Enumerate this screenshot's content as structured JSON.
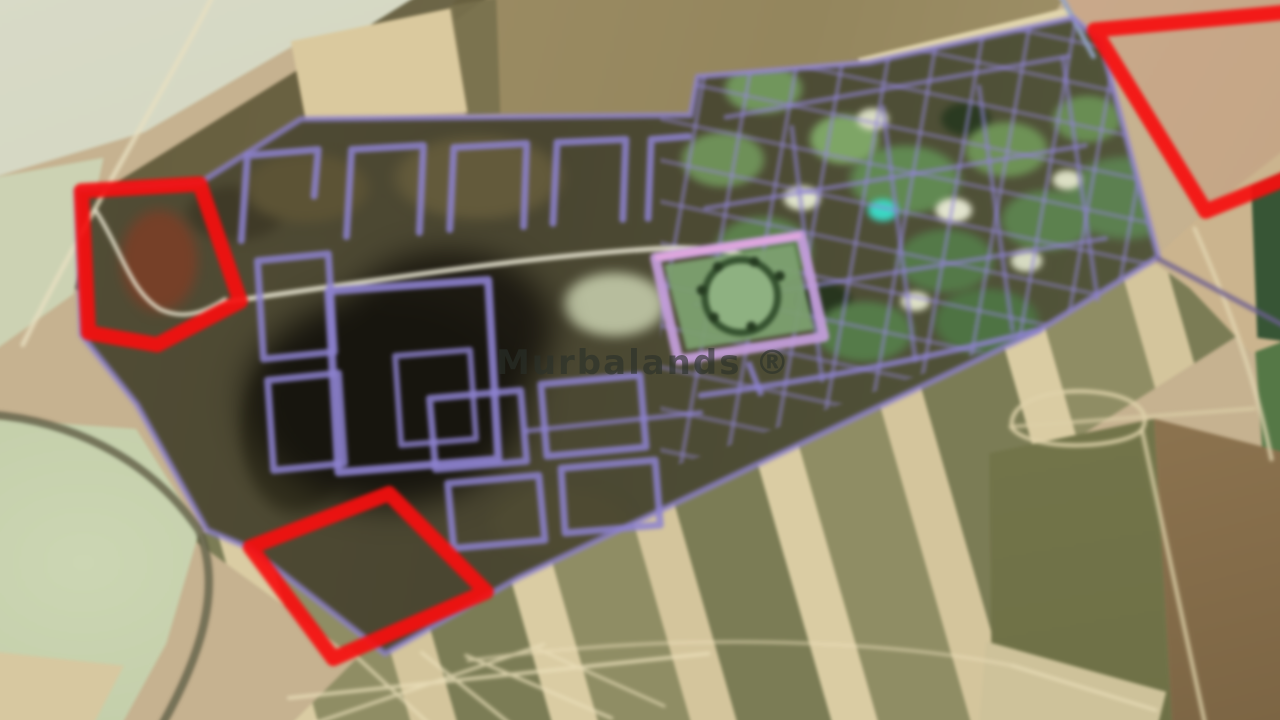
{
  "scene": {
    "kind": "aerial-satellite-photograph",
    "subject": "master-planned land development with purple street overlay, surrounded by farmland",
    "watermark": {
      "text": "Murbalands ®"
    },
    "colors": {
      "highlight_red": "#ee1111",
      "street_overlay_purple": "#8d82cc",
      "farmland_tan": "#c6b290",
      "development_dark_olive": "#4a4632"
    },
    "highlighted_plots": [
      {
        "name": "west-plot",
        "shape": "pentagon outline"
      },
      {
        "name": "southwest-plot",
        "shape": "diamond outline"
      },
      {
        "name": "northeast-plot",
        "shape": "polygon outline clipped by image edge"
      }
    ]
  }
}
